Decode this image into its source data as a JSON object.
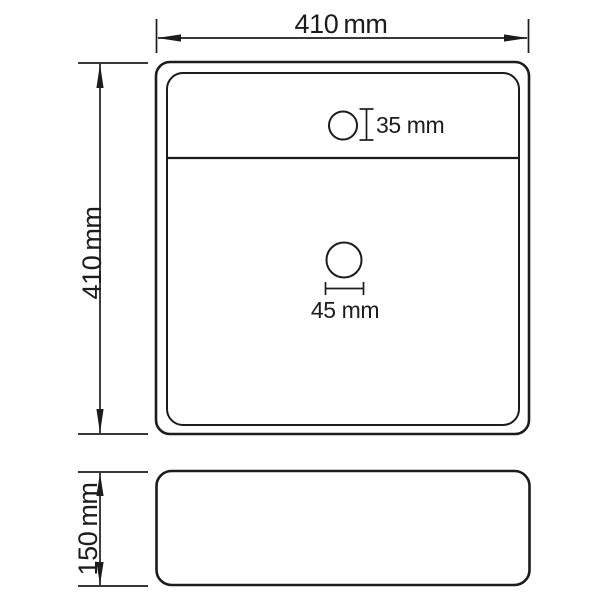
{
  "figure": {
    "colors": {
      "line": "#1c1c1c",
      "background": "#ffffff"
    },
    "dimensions": {
      "overall_width_label": "410 mm",
      "overall_depth_label": "410 mm",
      "height_label": "150 mm",
      "faucet_hole_label": "35 mm",
      "drain_hole_label": "45 mm"
    }
  }
}
